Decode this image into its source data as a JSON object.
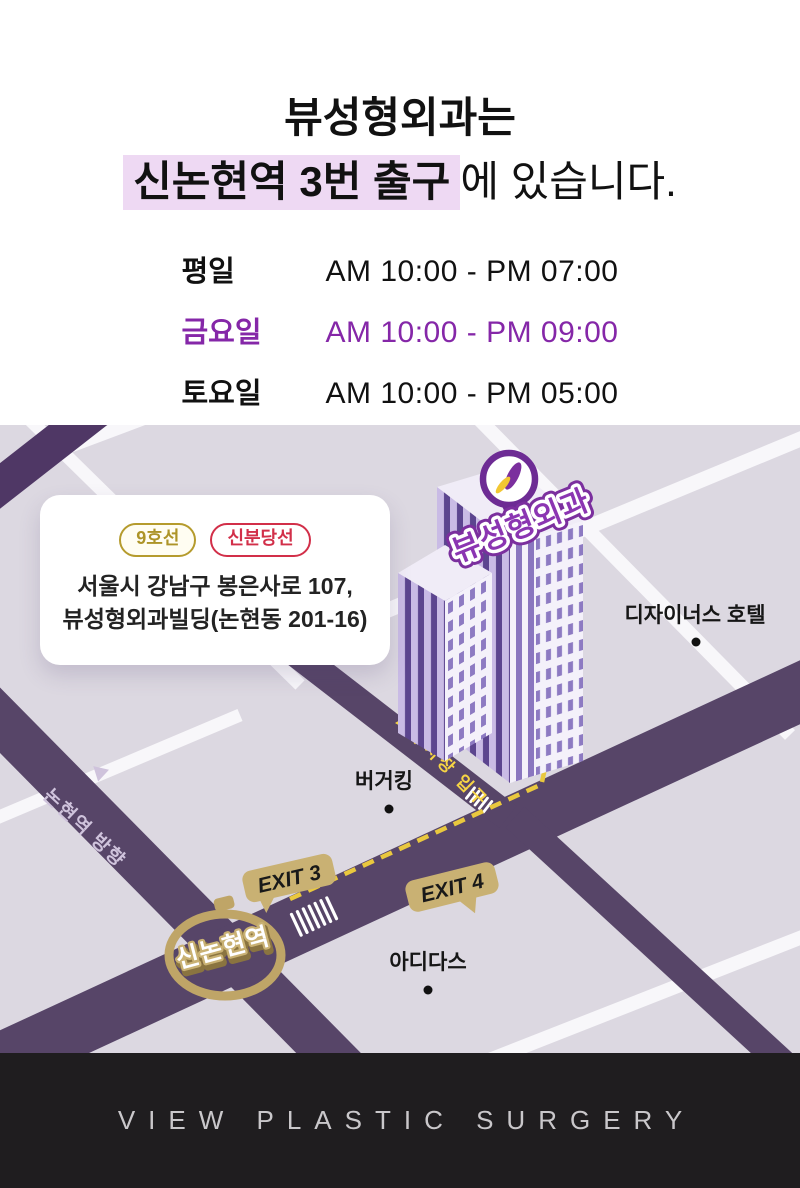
{
  "title": {
    "line1": "뷰성형외과는",
    "highlight": "신논현역 3번 출구",
    "suffix": "에 있습니다."
  },
  "hours": {
    "rows": [
      {
        "label": "평일",
        "time": "AM 10:00 - PM 07:00",
        "highlighted": false
      },
      {
        "label": "금요일",
        "time": "AM 10:00 - PM 09:00",
        "highlighted": true
      },
      {
        "label": "토요일",
        "time": "AM 10:00 - PM 05:00",
        "highlighted": false
      }
    ]
  },
  "map": {
    "subway_badges": [
      {
        "label": "9호선",
        "color": "#b3982e"
      },
      {
        "label": "신분당선",
        "color": "#d22f49"
      }
    ],
    "address_line1": "서울시 강남구 봉은사로 107,",
    "address_line2": "뷰성형외과빌딩(논현동 201-16)",
    "labels": {
      "clinic": "뷰성형외과",
      "hotel": "디자이너스 호텔",
      "burger_king": "버거킹",
      "adidas": "아디다스",
      "parking_entrance": "주차장 입구",
      "exit3": "EXIT 3",
      "exit4": "EXIT 4",
      "station": "신논현역",
      "direction": "논현역 방향"
    }
  },
  "footer": {
    "brand": "VIEW PLASTIC SURGERY"
  },
  "colors": {
    "accent_purple": "#8527a8",
    "title_highlight_bg": "#eed9f3",
    "map_bg": "#dcd8e1",
    "road_dark_purple": "#574568",
    "gold_tag": "#c9b173",
    "path_yellow": "#e9c83e",
    "clinic_label_purple": "#8b35b2",
    "footer_bg": "#1f1d1f"
  }
}
